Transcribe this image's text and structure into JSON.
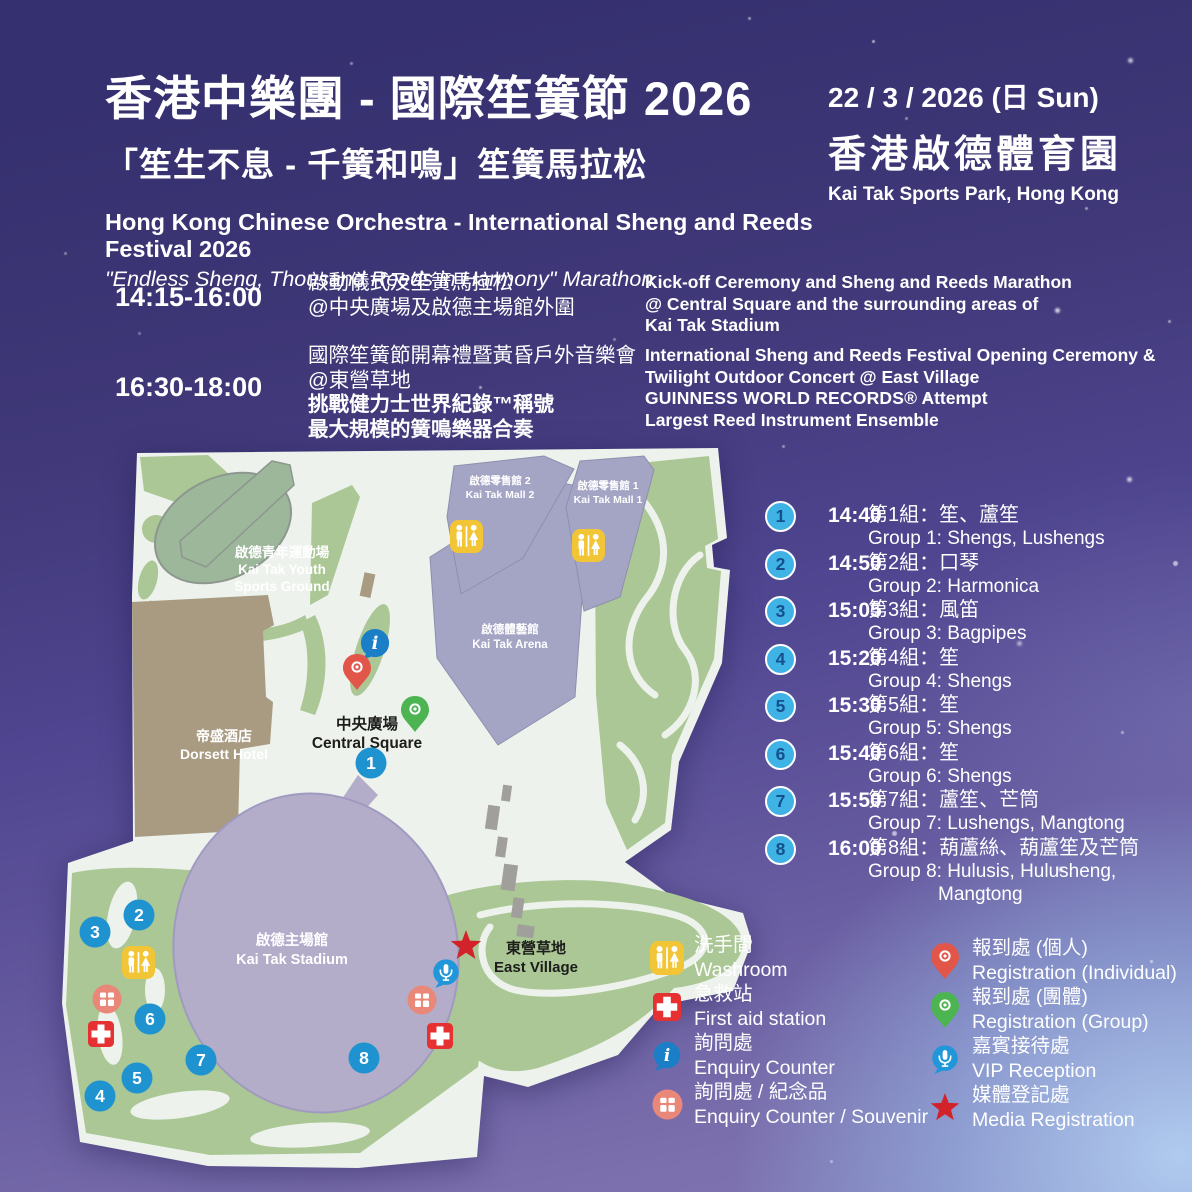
{
  "header": {
    "title_zh": "香港中樂團 - 國際笙簧節 2026",
    "subtitle_zh": "「笙生不息 - 千簧和鳴」笙簧馬拉松",
    "title_en": "Hong Kong Chinese Orchestra - International Sheng and Reeds Festival 2026",
    "subtitle_en": "\"Endless Sheng, Thousand Reeds in Harmony\" Marathon",
    "date": "22 / 3 / 2026 (日 Sun)",
    "venue_zh": "香港啟德體育園",
    "venue_en": "Kai Tak Sports Park, Hong Kong"
  },
  "schedule": {
    "row1": {
      "time": "14:15-16:00",
      "zh1": "啟動儀式及笙簧馬拉松",
      "zh2": "@中央廣場及啟德主場館外圍",
      "en1": "Kick-off Ceremony and Sheng and Reeds Marathon",
      "en2": "@ Central Square and the surrounding areas of",
      "en3": "Kai Tak Stadium"
    },
    "row2": {
      "time": "16:30-18:00",
      "zh1": "國際笙簧節開幕禮暨黃昏戶外音樂會",
      "zh2": "@東營草地",
      "zh3": "挑戰健力士世界紀錄™稱號",
      "zh4": "最大規模的簧鳴樂器合奏",
      "en1": "International Sheng and Reeds Festival Opening Ceremony &",
      "en2": "Twilight Outdoor Concert @ East Village",
      "en3_bold": "GUINNESS WORLD RECORDS®",
      "en3_rest": " Attempt",
      "en4": "Largest Reed Instrument Ensemble"
    }
  },
  "groups": {
    "items": [
      {
        "num": "1",
        "time": "14:40",
        "zh": "第1組：笙、蘆笙",
        "en": "Group 1: Shengs, Lushengs"
      },
      {
        "num": "2",
        "time": "14:50",
        "zh": "第2組：口琴",
        "en": "Group 2: Harmonica"
      },
      {
        "num": "3",
        "time": "15:05",
        "zh": "第3組：風笛",
        "en": "Group 3: Bagpipes"
      },
      {
        "num": "4",
        "time": "15:20",
        "zh": "第4組：笙",
        "en": "Group 4: Shengs"
      },
      {
        "num": "5",
        "time": "15:30",
        "zh": "第5組：笙",
        "en": "Group 5: Shengs"
      },
      {
        "num": "6",
        "time": "15:40",
        "zh": "第6組：笙",
        "en": "Group 6: Shengs"
      },
      {
        "num": "7",
        "time": "15:50",
        "zh": "第7組：蘆笙、芒筒",
        "en": "Group 7: Lushengs, Mangtong"
      },
      {
        "num": "8",
        "time": "16:00",
        "zh": "第8組：葫蘆絲、葫蘆笙及芒筒",
        "en": "Group 8: Hulusis, Hulusheng,",
        "en2": "Mangtong"
      }
    ]
  },
  "map": {
    "labels": {
      "youth_zh": "啟德青年運動場",
      "youth_en1": "Kai Tak Youth",
      "youth_en2": "Sports Ground",
      "dorsett_zh": "帝盛酒店",
      "dorsett_en": "Dorsett Hotel",
      "central_zh": "中央廣場",
      "central_en": "Central Square",
      "stadium_zh": "啟德主場館",
      "stadium_en": "Kai Tak Stadium",
      "arena_zh": "啟德體藝館",
      "arena_en": "Kai Tak Arena",
      "mall2_zh": "啟德零售館 2",
      "mall2_en": "Kai Tak Mall 2",
      "mall1_zh": "啟德零售館 1",
      "mall1_en": "Kai Tak Mall 1",
      "east_zh": "東營草地",
      "east_en": "East Village"
    },
    "markers": {
      "m1": "1",
      "m2": "2",
      "m3": "3",
      "m4": "4",
      "m5": "5",
      "m6": "6",
      "m7": "7",
      "m8": "8"
    }
  },
  "legend": {
    "left": [
      {
        "icon": "washroom-icon",
        "zh": "洗手間",
        "en": "Washroom"
      },
      {
        "icon": "first-aid-icon",
        "zh": "急救站",
        "en": "First aid station"
      },
      {
        "icon": "enquiry-icon",
        "zh": "詢問處",
        "en": "Enquiry Counter"
      },
      {
        "icon": "souvenir-icon",
        "zh": "詢問處 / 紀念品",
        "en": "Enquiry Counter / Souvenir"
      }
    ],
    "right": [
      {
        "icon": "pin-red-icon",
        "zh": "報到處 (個人)",
        "en": "Registration (Individual)"
      },
      {
        "icon": "pin-green-icon",
        "zh": "報到處 (團體)",
        "en": "Registration (Group)"
      },
      {
        "icon": "mic-icon",
        "zh": "嘉賓接待處",
        "en": "VIP Reception"
      },
      {
        "icon": "star-icon",
        "zh": "媒體登記處",
        "en": "Media Registration"
      }
    ]
  },
  "colors": {
    "marker_blue": "#1f93d0",
    "list_circle_blue": "#3fb3e5",
    "first_aid_red": "#e53131",
    "washroom_yellow": "#f2c537",
    "souvenir_salmon": "#e98878",
    "pin_red": "#e25549",
    "pin_green": "#4cb552",
    "star_red": "#d2232a",
    "map_green": "#aac795",
    "stadium_purple": "#b4adca"
  }
}
